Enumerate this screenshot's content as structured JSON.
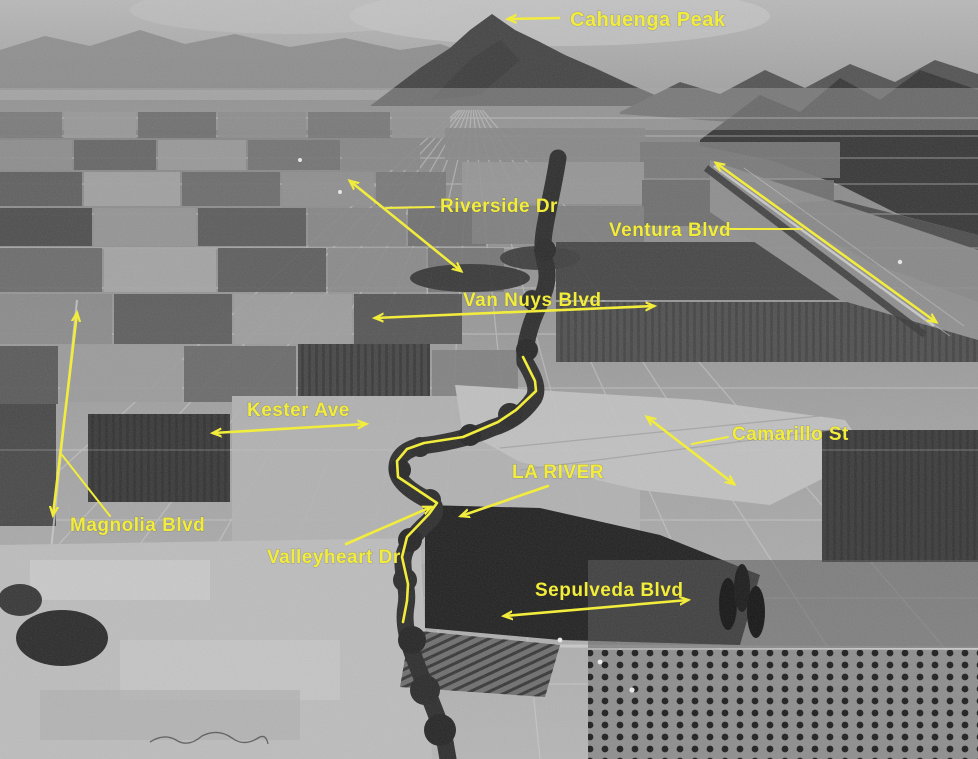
{
  "image": {
    "title": "Annotated aerial photograph, San Fernando Valley",
    "description": "Black-and-white oblique aerial photo of farmland with yellow street and landmark annotations"
  },
  "colors": {
    "annotation_yellow": "#f2ec3d"
  },
  "annotations": [
    {
      "id": "cahuenga-peak",
      "text": "Cahuenga Peak",
      "label": {
        "x": 570,
        "y": 26,
        "size": 20
      },
      "arrow": {
        "x1": 559,
        "y1": 18,
        "x2": 508,
        "y2": 19,
        "heads": "end"
      }
    },
    {
      "id": "riverside-dr",
      "text": "Riverside Dr",
      "label": {
        "x": 440,
        "y": 212,
        "size": 19
      },
      "arrow": {
        "x1": 350,
        "y1": 181,
        "x2": 461,
        "y2": 271,
        "heads": "both"
      },
      "leader": {
        "x1": 434,
        "y1": 207,
        "x2": 386,
        "y2": 208
      }
    },
    {
      "id": "ventura-blvd",
      "text": "Ventura Blvd",
      "label": {
        "x": 609,
        "y": 236,
        "size": 19
      },
      "arrow": {
        "x1": 716,
        "y1": 163,
        "x2": 936,
        "y2": 322,
        "heads": "both"
      },
      "leader": {
        "x1": 726,
        "y1": 229,
        "x2": 802,
        "y2": 229
      }
    },
    {
      "id": "van-nuys-blvd",
      "text": "Van Nuys Blvd",
      "label": {
        "x": 463,
        "y": 306,
        "size": 19
      },
      "arrow": {
        "x1": 375,
        "y1": 318,
        "x2": 654,
        "y2": 306,
        "heads": "both"
      }
    },
    {
      "id": "kester-ave",
      "text": "Kester Ave",
      "label": {
        "x": 247,
        "y": 416,
        "size": 19
      },
      "arrow": {
        "x1": 213,
        "y1": 433,
        "x2": 366,
        "y2": 424,
        "heads": "both"
      }
    },
    {
      "id": "camarillo-st",
      "text": "Camarillo St",
      "label": {
        "x": 732,
        "y": 440,
        "size": 19
      },
      "arrow": {
        "x1": 647,
        "y1": 417,
        "x2": 734,
        "y2": 484,
        "heads": "both"
      },
      "leader": {
        "x1": 728,
        "y1": 437,
        "x2": 692,
        "y2": 444
      }
    },
    {
      "id": "la-river",
      "text": "LA RIVER",
      "label": {
        "x": 512,
        "y": 478,
        "size": 19
      },
      "arrow": {
        "x1": 548,
        "y1": 486,
        "x2": 461,
        "y2": 516,
        "heads": "end"
      }
    },
    {
      "id": "magnolia-blvd",
      "text": "Magnolia Blvd",
      "label": {
        "x": 70,
        "y": 531,
        "size": 19
      },
      "arrow": {
        "x1": 77,
        "y1": 313,
        "x2": 53,
        "y2": 515,
        "heads": "both"
      },
      "leader": {
        "x1": 62,
        "y1": 455,
        "x2": 110,
        "y2": 516
      }
    },
    {
      "id": "valleyheart-dr",
      "text": "Valleyheart Dr",
      "label": {
        "x": 267,
        "y": 563,
        "size": 19
      },
      "arrow": {
        "x1": 346,
        "y1": 544,
        "x2": 431,
        "y2": 507,
        "heads": "end"
      }
    },
    {
      "id": "sepulveda-blvd",
      "text": "Sepulveda Blvd",
      "label": {
        "x": 535,
        "y": 596,
        "size": 19
      },
      "arrow": {
        "x1": 504,
        "y1": 616,
        "x2": 688,
        "y2": 600,
        "heads": "both"
      }
    }
  ],
  "river_trace": {
    "name": "LA River course trace",
    "points": [
      [
        523,
        357
      ],
      [
        535,
        381
      ],
      [
        536,
        391
      ],
      [
        516,
        410
      ],
      [
        498,
        422
      ],
      [
        463,
        437
      ],
      [
        424,
        443
      ],
      [
        407,
        449
      ],
      [
        397,
        461
      ],
      [
        398,
        477
      ],
      [
        419,
        491
      ],
      [
        437,
        503
      ],
      [
        429,
        514
      ],
      [
        407,
        537
      ],
      [
        402,
        557
      ],
      [
        408,
        584
      ],
      [
        407,
        601
      ],
      [
        403,
        622
      ]
    ]
  }
}
